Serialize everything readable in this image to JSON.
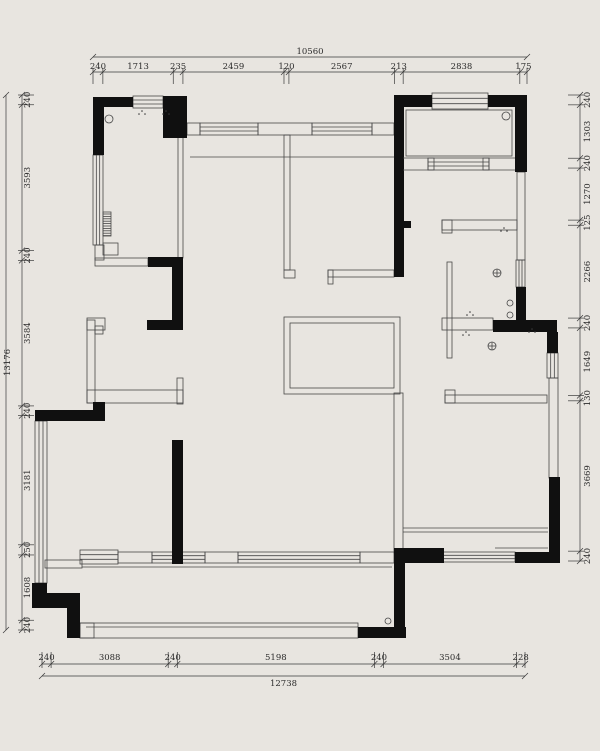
{
  "plan": {
    "type": "architectural-floor-plan",
    "units": "mm"
  },
  "colors": {
    "background": "#e8e5e0",
    "line": "#474747",
    "structural_wall_fill": "#101010",
    "window_fill": "#f6f4f0",
    "dim_text": "#2b2b2b"
  },
  "dimensions": {
    "top": {
      "total": "10560",
      "segments": [
        "240",
        "1713",
        "235",
        "2459",
        "120",
        "2567",
        "213",
        "2838",
        "175"
      ]
    },
    "bottom": {
      "total": "12738",
      "segments": [
        "240",
        "3088",
        "240",
        "5198",
        "240",
        "3504",
        "228"
      ]
    },
    "left": {
      "total": "13176",
      "segments": [
        "240",
        "3593",
        "240",
        "3584",
        "240",
        "3181",
        "250",
        "1608",
        "240"
      ]
    },
    "right": {
      "segments": [
        "240",
        "1303",
        "240",
        "1270",
        "125",
        "2266",
        "240",
        "1649",
        "130",
        "3669",
        "240"
      ]
    }
  },
  "symbols": {
    "floor_drain": "circle-with-cross",
    "ceiling_point": "small-circle",
    "pipe_stack": "double-small-circle",
    "radiator": "hatched-strip",
    "spot_dots": "dot-cluster"
  }
}
